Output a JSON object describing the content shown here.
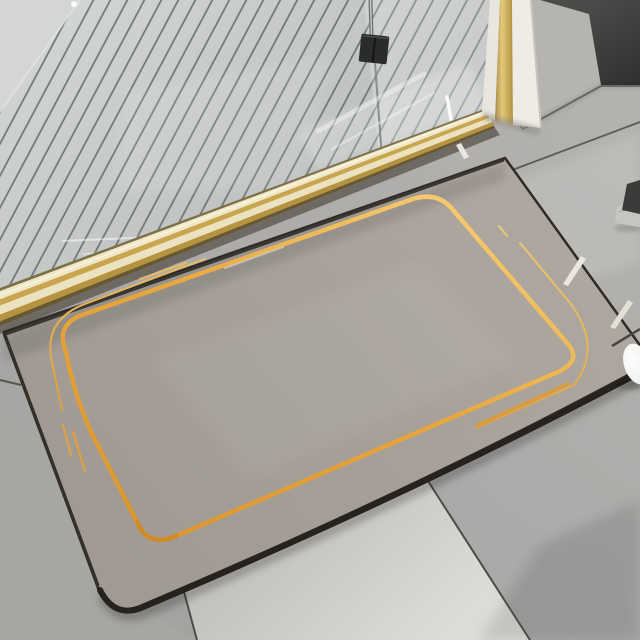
{
  "scene": {
    "type": "product-photo",
    "description": "Gray diatomite bath mat with a gold foil line border lying on large gray floor tiles in front of a walk-in shower with a slatted shower floor, glass panel, black glass clamp and brass threshold strip",
    "objects": [
      "shower-slatted-floor",
      "glass-panel",
      "glass-clamp",
      "support-rod",
      "brass-threshold",
      "door-frame",
      "light-wall",
      "dark-wall",
      "bath-mat",
      "gold-line-design",
      "floor-tiles",
      "grout-lines",
      "cream-floor-dashes",
      "dark-object-right-edge",
      "metal-stick",
      "white-egg-object"
    ]
  },
  "colors": {
    "floor_light": "#b3b2af",
    "floor_mid": "#adacaa",
    "floor_dark": "#a3a3a1",
    "tile_top": "#bebdb9",
    "tile_bright": "#dcdbd7",
    "grout": "#54524f",
    "shower_top": "#d3d6d5",
    "shower_bottom": "#bcbfbe",
    "slat_groove": "#5f6468",
    "wedge_wall": "#d4d6d5",
    "wall_light": "#b6b4b1",
    "wall_dark_top": "#4c4b49",
    "wall_dark_bottom": "#313030",
    "frame_white": "#e9e6df",
    "jamb_white": "#efece5",
    "brass_dark": "#8a6d2f",
    "brass_bright": "#e3c979",
    "brass_mid": "#b08c3e",
    "threshold_line": "#7d7048",
    "threshold_cream": "#f0e7c6",
    "threshold_gold": "#c9a54e",
    "threshold_cream2": "#ece2c0",
    "threshold_gold2": "#b6933f",
    "threshold_dark": "#675834",
    "shadow_gap": "#6e6a63",
    "mat_light": "#b1aaa2",
    "mat_mid": "#a6a099",
    "mat_dark": "#9f9992",
    "mat_edge": "#26231f",
    "mat_edge_top": "#3a3631",
    "gold_bright": "#f5cb70",
    "gold_mid": "#e8a63c",
    "gold_deep": "#dd9830",
    "gold_outer_light": "#eec878",
    "gold_outer_deep": "#dfa040",
    "gold_accent": "#e09a30",
    "clamp_black": "#2a2b2d",
    "rod_gray": "#6e7072",
    "egg_white": "#f0f1ee",
    "cream_dash": "#e9e7e0",
    "stick": "#4a463f"
  }
}
